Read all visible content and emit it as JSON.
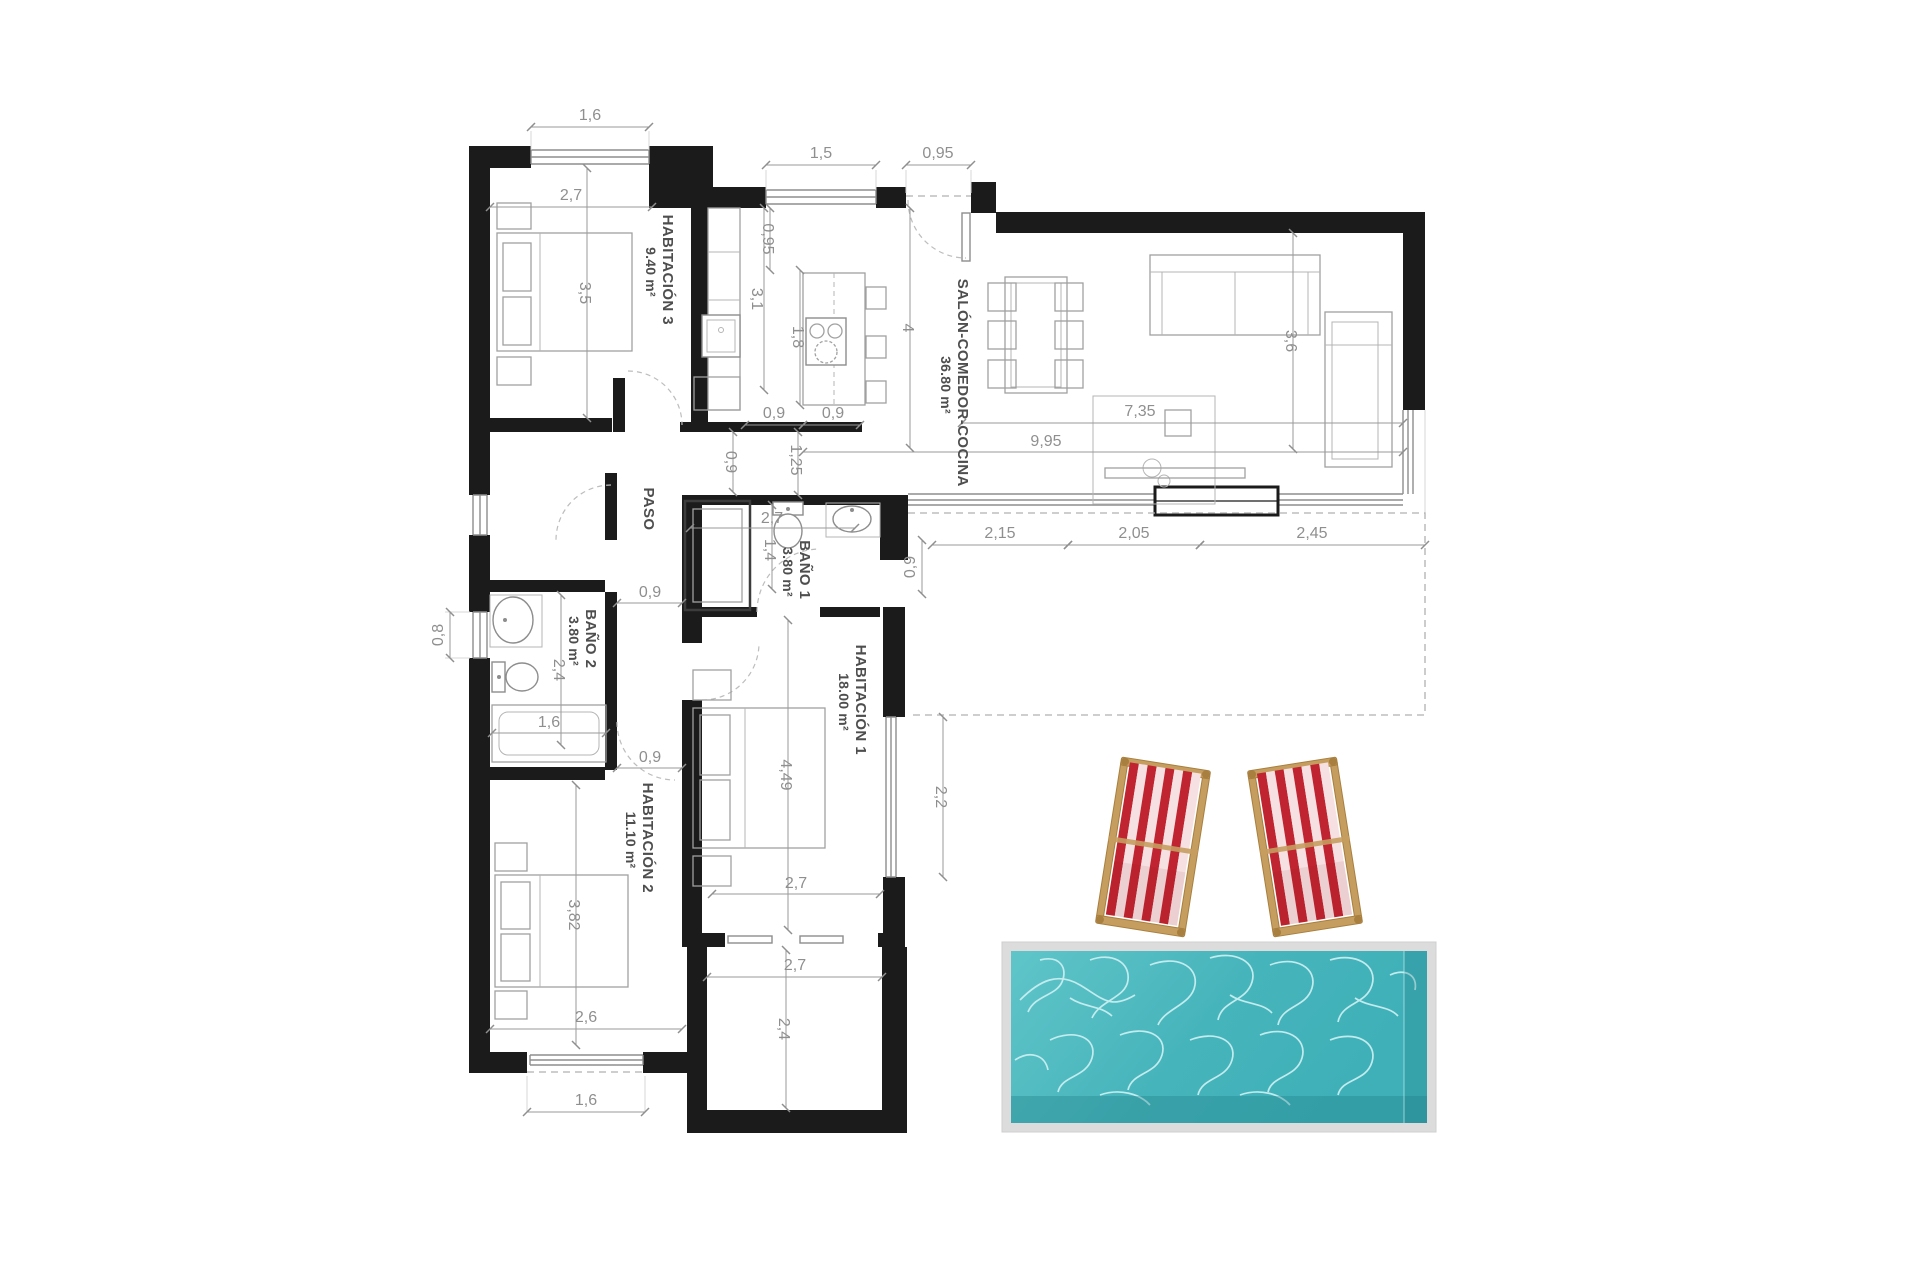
{
  "plan": {
    "type": "architectural floor plan",
    "language": "es",
    "rooms": {
      "hab3": {
        "name": "HABITACIÓN 3",
        "area": "9.40 m²"
      },
      "salon": {
        "name": "SALÓN-COMEDOR-COCINA",
        "area": "36.80 m²"
      },
      "paso": {
        "name": "PASO",
        "area": ""
      },
      "bano1": {
        "name": "BAÑO 1",
        "area": "3.80 m²"
      },
      "bano2": {
        "name": "BAÑO 2",
        "area": "3.80 m²"
      },
      "hab1": {
        "name": "HABITACIÓN 1",
        "area": "18.00 m²"
      },
      "hab2": {
        "name": "HABITACIÓN 2",
        "area": "11.10 m²"
      }
    },
    "dims": {
      "hab3_window": "1,6",
      "hab3_width": "2,7",
      "kitchen_window": "1,5",
      "entrance_width": "0,95",
      "kitchen_top_gap": "0,95",
      "kitchen_counter_len": "3,1",
      "island_len": "1,8",
      "salon_depth": "4",
      "hab3_depth": "3,5",
      "salon_width": "9,95",
      "salon_inner_width": "7,35",
      "salon_height": "3,6",
      "island_gap": "0,9",
      "island_width": "0,9",
      "paso_to_bath": "1,25",
      "salon_pass_gap": "0,9",
      "terrace_seg1": "2,15",
      "terrace_seg2": "2,05",
      "terrace_seg3": "2,45",
      "terrace_depth": "0,9",
      "bano1_width": "2,7",
      "bano1_depth": "1,4",
      "paso_door": "0,9",
      "bano2_depth": "2,4",
      "bano2_window": "0,8",
      "bano2_tub": "1,6",
      "hab2_door": "0,9",
      "hab1_length": "4,49",
      "hab1_window": "2,2",
      "hab1_width": "2,7",
      "hab2_length": "3,82",
      "hab2_width": "2,6",
      "store_width": "2,7",
      "store_depth": "2,4",
      "hab2_bottom_window": "1,6"
    },
    "colors": {
      "wall": "#1b1b1b",
      "dimension_text": "#8f8f8f",
      "room_text": "#4e4e4e",
      "pool_border": "#d6d6d6",
      "pool_water_light": "#5fc5c9",
      "pool_water": "#3fb0b8",
      "pool_water_dark": "#2b9ca4",
      "pool_caustics": "#c9eff1",
      "deckchair_red": "#bf2430",
      "deckchair_white": "#f6e0e1",
      "deckchair_wood": "#c59d5f"
    },
    "objects": [
      "swimming-pool",
      "deck-chair",
      "deck-chair"
    ]
  }
}
